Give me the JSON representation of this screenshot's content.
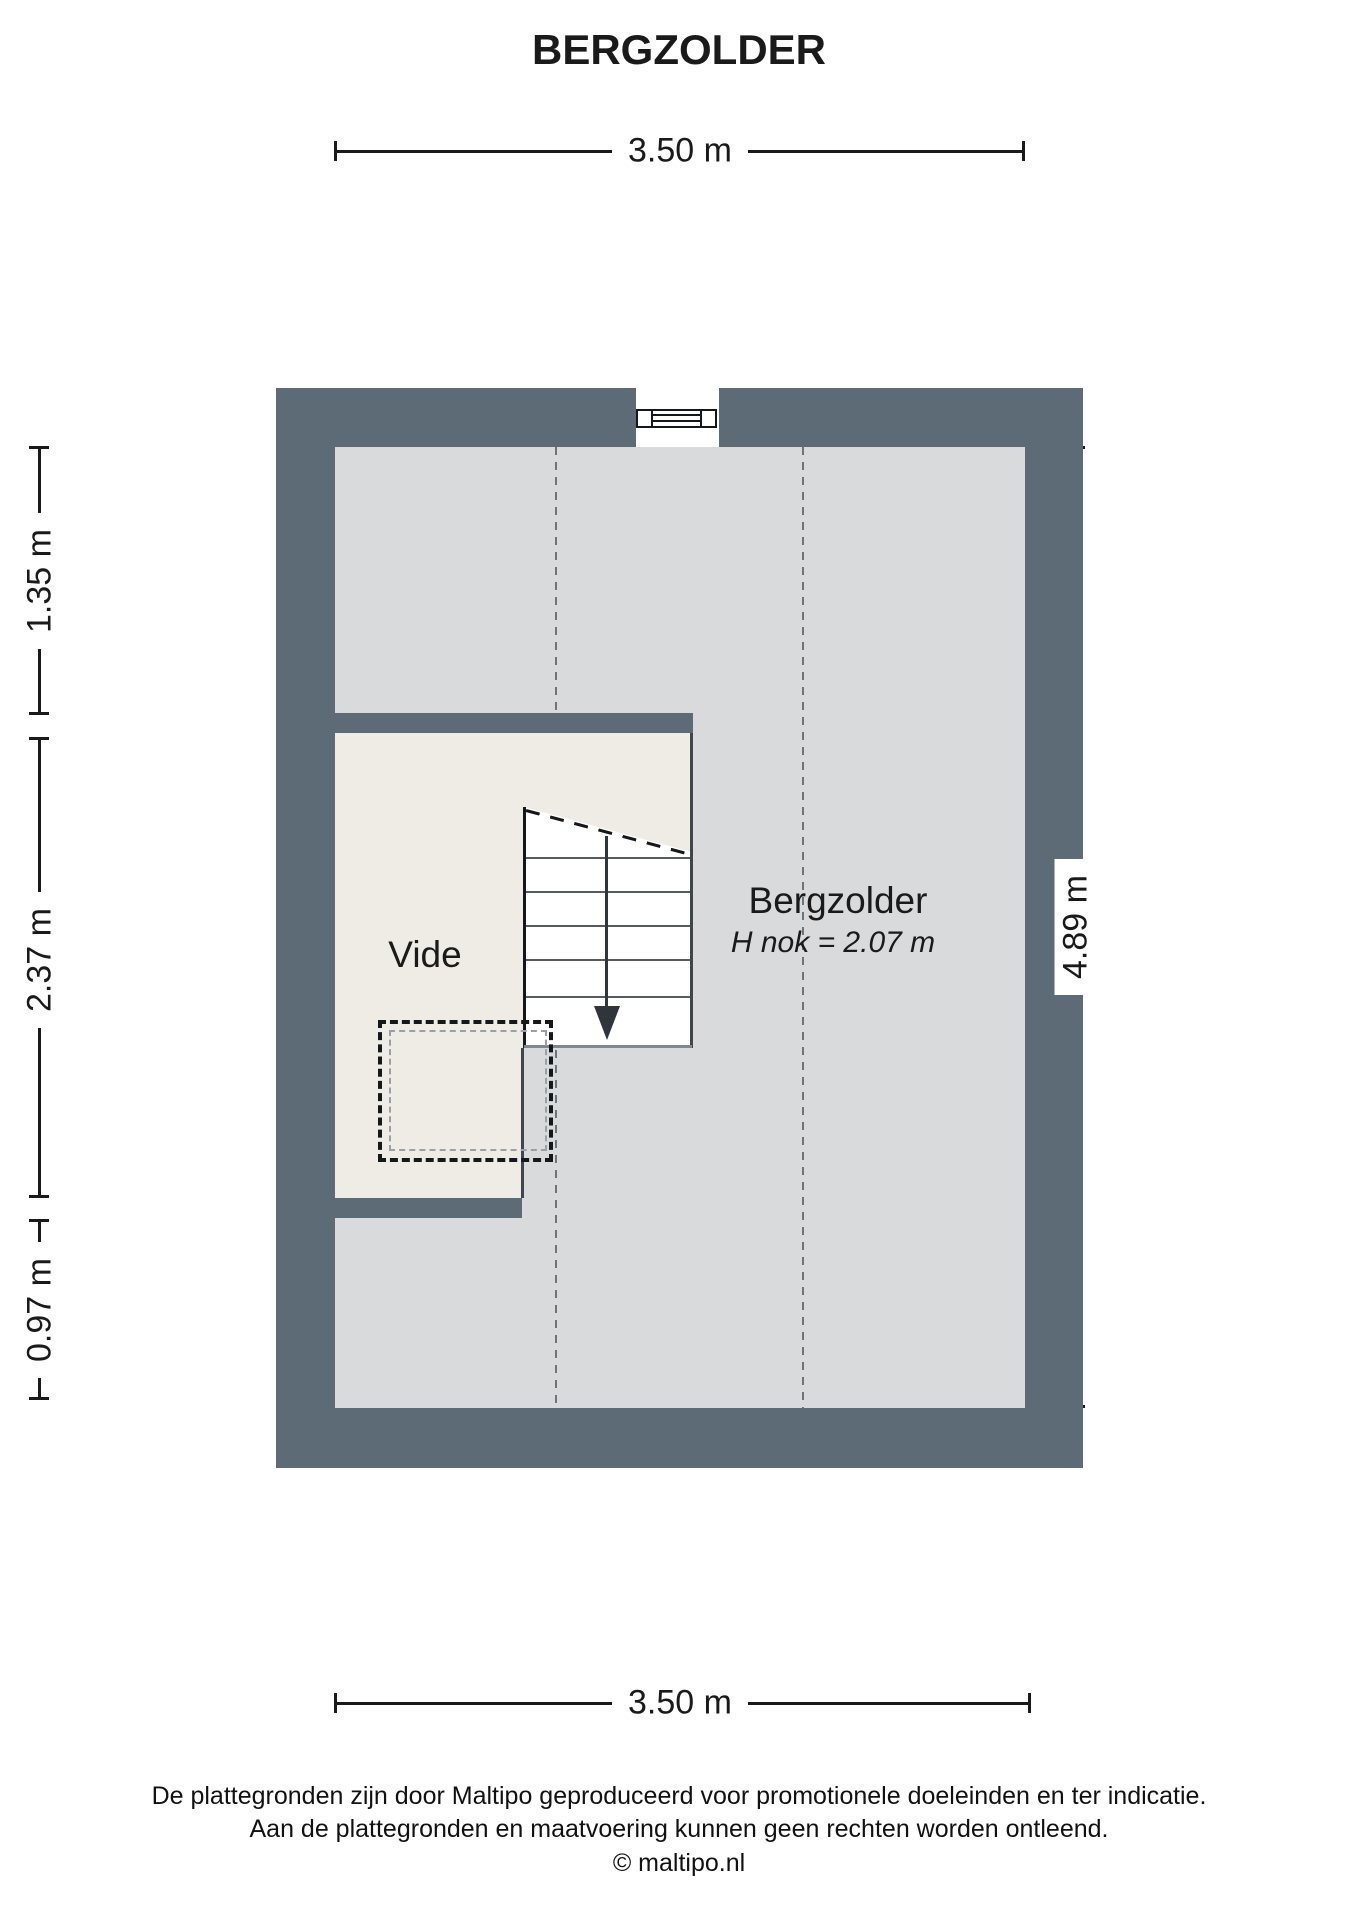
{
  "title": "BERGZOLDER",
  "dims": {
    "top": "3.50 m",
    "bottom": "3.50 m",
    "right": "4.89 m",
    "left_segments": [
      "1.35 m",
      "2.37 m",
      "0.97 m"
    ]
  },
  "rooms": {
    "main": {
      "name": "Bergzolder",
      "height_note": "H nok = 2.07 m"
    },
    "vide": {
      "name": "Vide"
    }
  },
  "footer": {
    "line1": "De plattegronden zijn door Maltipo geproduceerd voor promotionele doeleinden en ter indicatie.",
    "line2": "Aan de plattegronden en maatvoering kunnen geen rechten worden ontleend.",
    "line3": "© maltipo.nl"
  },
  "colors": {
    "wall": "#5c6b75",
    "floor": "#d9dadc",
    "vide": "#eeece4",
    "ink": "#1a1a1a",
    "dash": "#6d757c"
  }
}
